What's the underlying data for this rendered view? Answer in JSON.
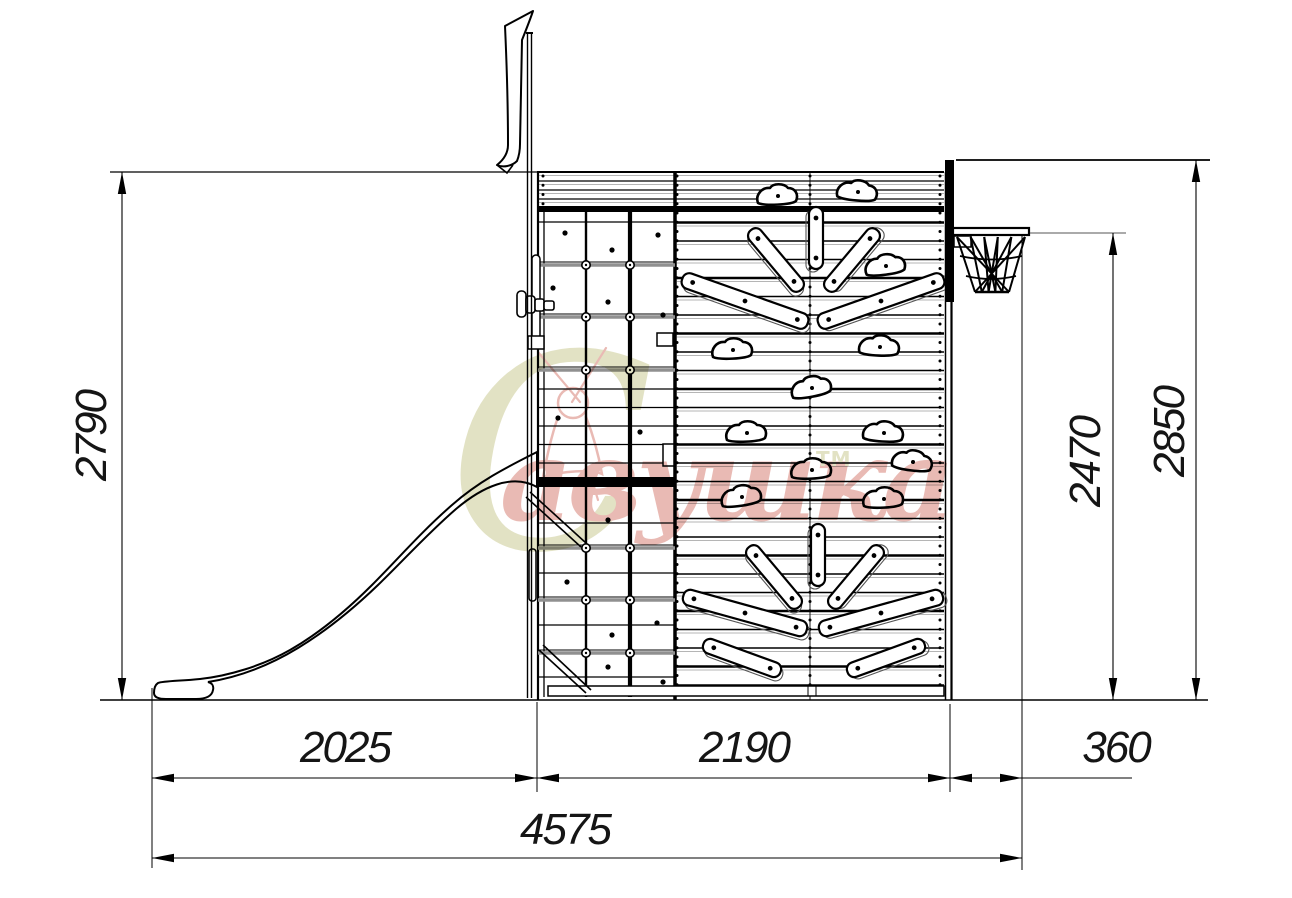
{
  "watermark": {
    "initial": "С",
    "rest": "авушка",
    "trademark": "ТМ",
    "red_color": "#d4766a",
    "olive_color": "#c6c68a"
  },
  "dimensions": {
    "overall_height": "2790",
    "backboard_height": "2850",
    "ring_height": "2470",
    "slide_span": "2025",
    "wall_span": "2190",
    "ring_offset": "360",
    "total_length": "4575"
  }
}
